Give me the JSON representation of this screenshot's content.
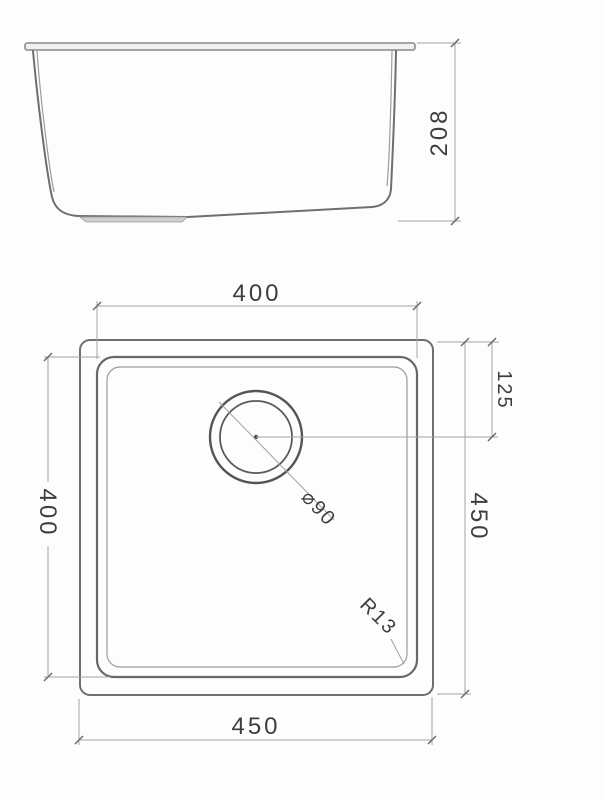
{
  "colors": {
    "background": "#fdfdfd",
    "object_line": "#6f6f6f",
    "object_line_dark": "#555555",
    "dimension_line": "#a2a2a2",
    "text": "#3e3e3e"
  },
  "side_view": {
    "height_dim": "208"
  },
  "plan_view": {
    "top_width_dim": "400",
    "left_height_dim": "400",
    "drain_offset_dim": "125",
    "right_height_dim": "450",
    "bottom_width_dim": "450",
    "drain_diameter": "⌀90",
    "corner_radius": "R13"
  }
}
